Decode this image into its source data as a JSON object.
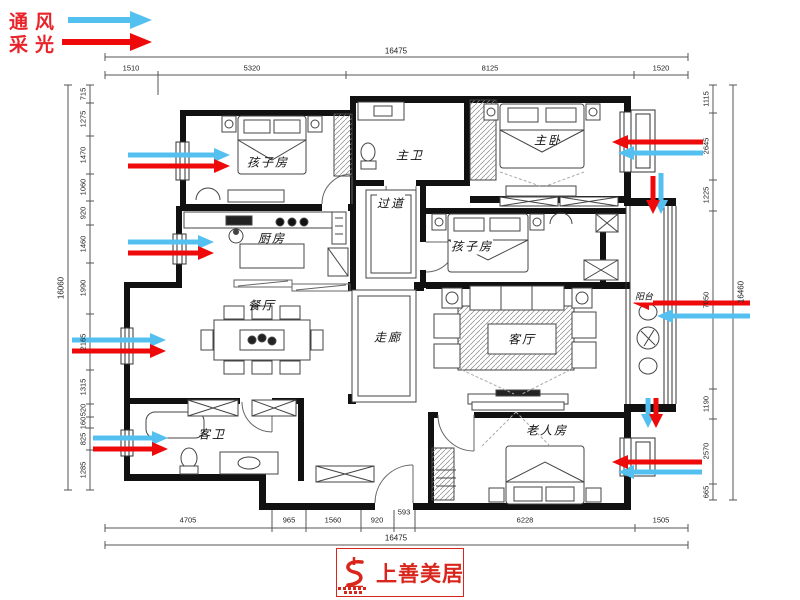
{
  "legend": {
    "ventilation_label": "通风",
    "daylight_label": "采光",
    "ventilation_color": "#54c0f0",
    "daylight_color": "#ee0a0a"
  },
  "rooms": {
    "child_room_1": "孩子房",
    "master_bath": "主卫",
    "master_bedroom": "主卧",
    "passage": "过道",
    "kitchen": "厨房",
    "child_room_2": "孩子房",
    "dining_room": "餐厅",
    "corridor": "走廊",
    "living_room": "客厅",
    "balcony": "阳台",
    "guest_bath": "客卫",
    "elder_room": "老人房"
  },
  "dimensions": {
    "top": {
      "total": "16475",
      "segments": [
        "1510",
        "5320",
        "8125",
        "1520"
      ]
    },
    "bottom": {
      "total": "16475",
      "segments": [
        "4705",
        "965",
        "1560",
        "920",
        "593",
        "6228",
        "1505"
      ]
    },
    "left": {
      "total": "16060",
      "segments": [
        "715",
        "1275",
        "1470",
        "1060",
        "920",
        "1460",
        "1990",
        "2165",
        "1315",
        "520",
        "160",
        "825",
        "1285"
      ]
    },
    "right": {
      "total": "16460",
      "segments": [
        "1115",
        "2645",
        "1225",
        "7050",
        "1190",
        "2570",
        "665"
      ]
    }
  },
  "logo": {
    "brand": "上善美居"
  }
}
